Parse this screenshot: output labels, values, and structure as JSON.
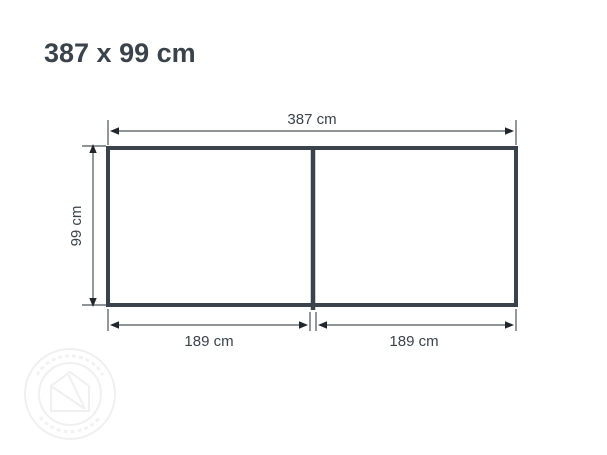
{
  "page": {
    "title": "387 x 99 cm",
    "background_color": "#ffffff"
  },
  "diagram": {
    "type": "dimension-drawing",
    "object": "two-section rectangular panel, front view",
    "overall": {
      "width_label": "387 cm",
      "height_label": "99 cm"
    },
    "sections": [
      {
        "width_label": "189 cm"
      },
      {
        "width_label": "189 cm"
      }
    ],
    "colors": {
      "outline": "#3a434b",
      "dimension_line": "#4d545a",
      "arrowhead": "#21262a",
      "label_text": "#3a434b",
      "watermark": "#f0f0f0"
    }
  }
}
